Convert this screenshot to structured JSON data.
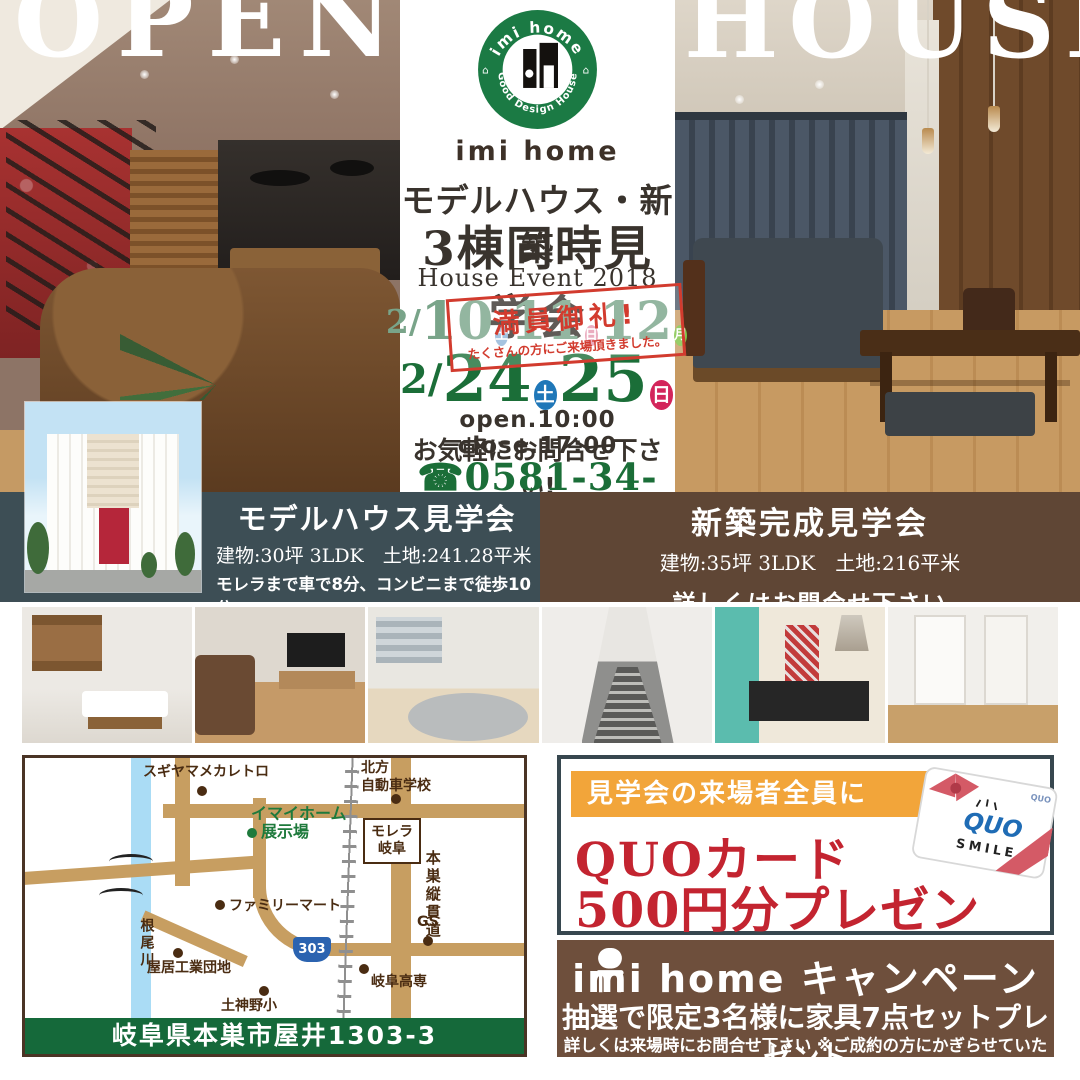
{
  "brand": {
    "logo_arc_top": "imi home",
    "logo_arc_bottom": "Good Design House",
    "name": "imi home"
  },
  "hero": {
    "left": "OPEN",
    "right": "HOUSE"
  },
  "event": {
    "title1": "モデルハウス・新築",
    "title2": "3棟同時見学会",
    "subtitle": "House Event 2018",
    "row1": {
      "prefix": "2/",
      "d1": "10",
      "b1": "土",
      "d2": "11",
      "b2": "日",
      "d3": "12",
      "b3": "月"
    },
    "stamp": {
      "line1": "満員御礼!",
      "line2": "たくさんの方にご来場頂きました。"
    },
    "row2": {
      "prefix": "2/",
      "d1": "24",
      "b1": "土",
      "d2": "25",
      "b2": "日"
    },
    "hours": "open.10:00 close.17:00",
    "note": "お気軽にお問合せ下さい!",
    "phone_icon": "☎",
    "phone": "0581-34-3487"
  },
  "venue_left": {
    "title": "モデルハウス見学会",
    "specs": "建物:30坪 3LDK　土地:241.28平米",
    "access": "モレラまで車で8分、コンビニまで徒歩10分",
    "district": "学区（土貴野小学校区・糸貫中学校区）"
  },
  "venue_right": {
    "title": "新築完成見学会",
    "specs": "建物:35坪 3LDK　土地:216平米",
    "note": "詳しくはお問合せ下さい"
  },
  "map": {
    "address": "岐阜県本巣市屋井1303-3",
    "route": "303",
    "labels": {
      "sugiyama": "スギヤマメカレトロ",
      "kitagata1": "北方",
      "kitagata2": "自動車学校",
      "imai1": "イマイホーム",
      "imai2": "展示場",
      "morera1": "モレラ",
      "morera2": "岐阜",
      "juukando": "本巣縦貫道",
      "famima": "ファミリーマート",
      "neogawa": "根尾川",
      "yai": "屋居工業団地",
      "dojinno": "土神野小",
      "kosen": "岐阜高専",
      "gs": "GS"
    }
  },
  "quo": {
    "band": "見学会の来場者全員に",
    "line1": "QUOカード",
    "line2": "500円分プレゼント!",
    "card_brand": "QUO",
    "card_smile": "SMILE"
  },
  "campaign": {
    "title": "imi home キャンペーン",
    "line1": "抽選で限定3名様に家具7点セットプレゼント",
    "line2": "詳しくは来場時にお問合せ下さい ※ご成約の方にかぎらせていただきます"
  },
  "colors": {
    "brand_green": "#1b6e38",
    "stamp_red": "#d23b2e",
    "quo_red": "#c32430",
    "band_slate": "#3d4e55",
    "band_brown": "#5f4635",
    "campaign_brown": "#6e4f3c",
    "orange": "#f2a53a",
    "badge_sat": "#1f77b8",
    "badge_sun": "#d3255b",
    "badge_mon": "#7dc243"
  }
}
